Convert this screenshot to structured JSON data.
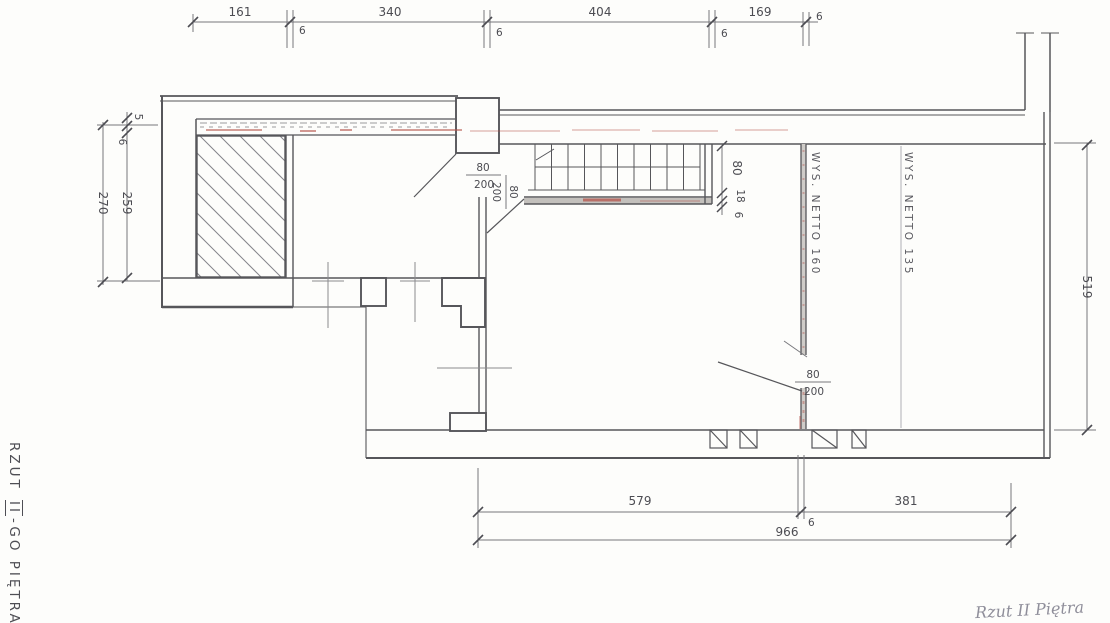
{
  "drawing": {
    "side_title": {
      "full": "RZUT II-GO PIĘTRA",
      "prefix": "RZUT ",
      "numeral": "II",
      "suffix": "-GO PIĘTRA"
    },
    "hand_note": "Rzut II Piętra",
    "annotations": {
      "wys_netto_160": "WYS. NETTO 160",
      "wys_netto_135": "WYS. NETTO 135"
    },
    "door_label": {
      "width": "80",
      "height": "200"
    },
    "dimensions": {
      "top": [
        "161",
        "6",
        "340",
        "6",
        "404",
        "6",
        "169",
        "6"
      ],
      "left_outer": "270",
      "left_inner": [
        "5",
        "6",
        "259"
      ],
      "stair": [
        "80",
        "18",
        "6"
      ],
      "right": "519",
      "bottom_row1": [
        "579",
        "6",
        "381"
      ],
      "bottom_row2": "966"
    },
    "colors": {
      "paper": "#fdfdfb",
      "pencil_line": "#56565a",
      "dim_line": "#77777b",
      "accent_red": "#b5544b",
      "stair_band_fill": "#c3c0bc"
    }
  }
}
